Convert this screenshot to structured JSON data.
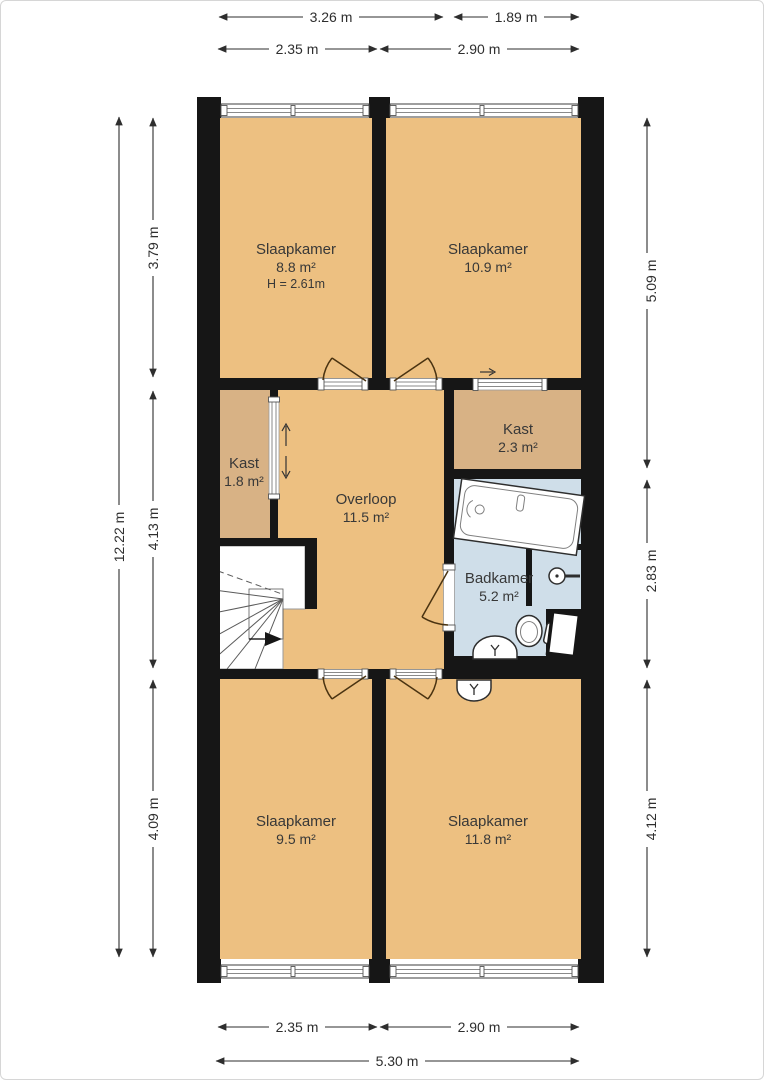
{
  "title": "floor-plan-upper-storey",
  "rooms": {
    "bedroom_top_left": {
      "name": "Slaapkamer",
      "area": "8.8 m²",
      "height_note": "H = 2.61m"
    },
    "bedroom_top_right": {
      "name": "Slaapkamer",
      "area": "10.9 m²"
    },
    "closet_left": {
      "name": "Kast",
      "area": "1.8 m²"
    },
    "closet_right": {
      "name": "Kast",
      "area": "2.3 m²"
    },
    "landing": {
      "name": "Overloop",
      "area": "11.5 m²"
    },
    "bathroom": {
      "name": "Badkamer",
      "area": "5.2 m²"
    },
    "bedroom_bottom_left": {
      "name": "Slaapkamer",
      "area": "9.5 m²"
    },
    "bedroom_bottom_right": {
      "name": "Slaapkamer",
      "area": "11.8 m²"
    }
  },
  "dimensions": {
    "top_outer_left": "3.26 m",
    "top_outer_right": "1.89 m",
    "top_inner_left": "2.35 m",
    "top_inner_right": "2.90 m",
    "bottom_left": "2.35 m",
    "bottom_right": "2.90 m",
    "bottom_total": "5.30 m",
    "left_total": "12.22 m",
    "left_top": "3.79 m",
    "left_middle": "4.13 m",
    "left_bottom": "4.09 m",
    "right_top": "5.09 m",
    "right_middle": "2.83 m",
    "right_bottom": "4.12 m"
  },
  "colors": {
    "floor": "#edc081",
    "closet": "#d8b285",
    "bathroom": "#cfdee9",
    "wall": "#161616"
  }
}
